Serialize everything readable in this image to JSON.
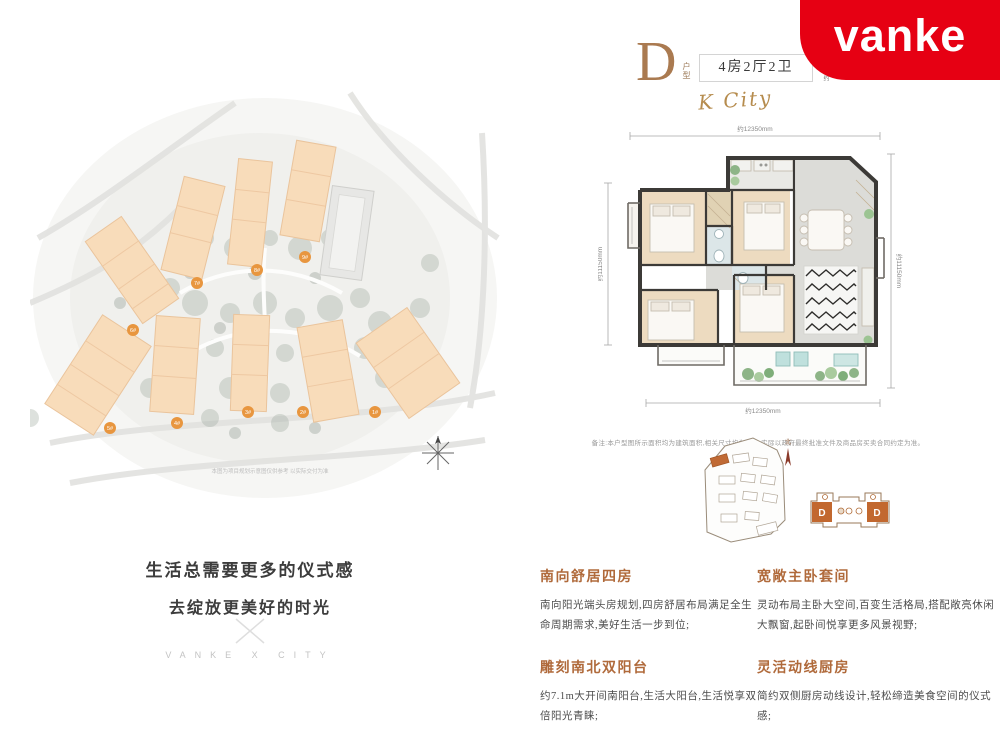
{
  "brand": {
    "logo_text": "vanke",
    "logo_bg": "#e60013"
  },
  "header": {
    "plan_letter": "D",
    "plan_type_label": "户型",
    "rooms_label": "4房2厅2卫",
    "area_prefix": "建筑面积约",
    "area_number": "135",
    "area_unit": "M²",
    "signature": "K City"
  },
  "slogan": {
    "line1": "生活总需要更多的仪式感",
    "line2": "去绽放更美好的时光",
    "brand_line": "VANKE X CITY"
  },
  "masterplan": {
    "caption": "本图为项目规划示意图仅供参考 以实际交付为准",
    "badges": [
      "5#",
      "4#",
      "3#",
      "2#",
      "1#",
      "6#",
      "7#",
      "8#",
      "9#"
    ]
  },
  "floorplan": {
    "dim_top": "约12350mm",
    "dim_bottom": "约12350mm",
    "dim_left": "约11150mm",
    "dim_right": "约11150mm",
    "disclaimer": "备注:本户型图所示面积均为建筑面积,相关尺寸均为约数,实际以政府最终批准文件及商品房买卖合同约定为准。",
    "keyplan_compass": "北",
    "unit_label_left": "D",
    "unit_label_right": "D"
  },
  "features": [
    {
      "title": "南向舒居四房",
      "body": "南向阳光端头房规划,四房舒居布局满足全生命周期需求,美好生活一步到位;"
    },
    {
      "title": "宽敞主卧套间",
      "body": "灵动布局主卧大空间,百变生活格局,搭配敞亮休闲大飘窗,起卧间悦享更多风景视野;"
    },
    {
      "title": "雕刻南北双阳台",
      "body": "约7.1m大开间南阳台,生活大阳台,生活悦享双倍阳光青睐;"
    },
    {
      "title": "灵活动线厨房",
      "body": "简约双侧厨房动线设计,轻松缔造美食空间的仪式感;"
    }
  ],
  "colors": {
    "brand_red": "#e60013",
    "accent_bronze": "#b06a3b",
    "building_orange": "#f8dcba"
  }
}
